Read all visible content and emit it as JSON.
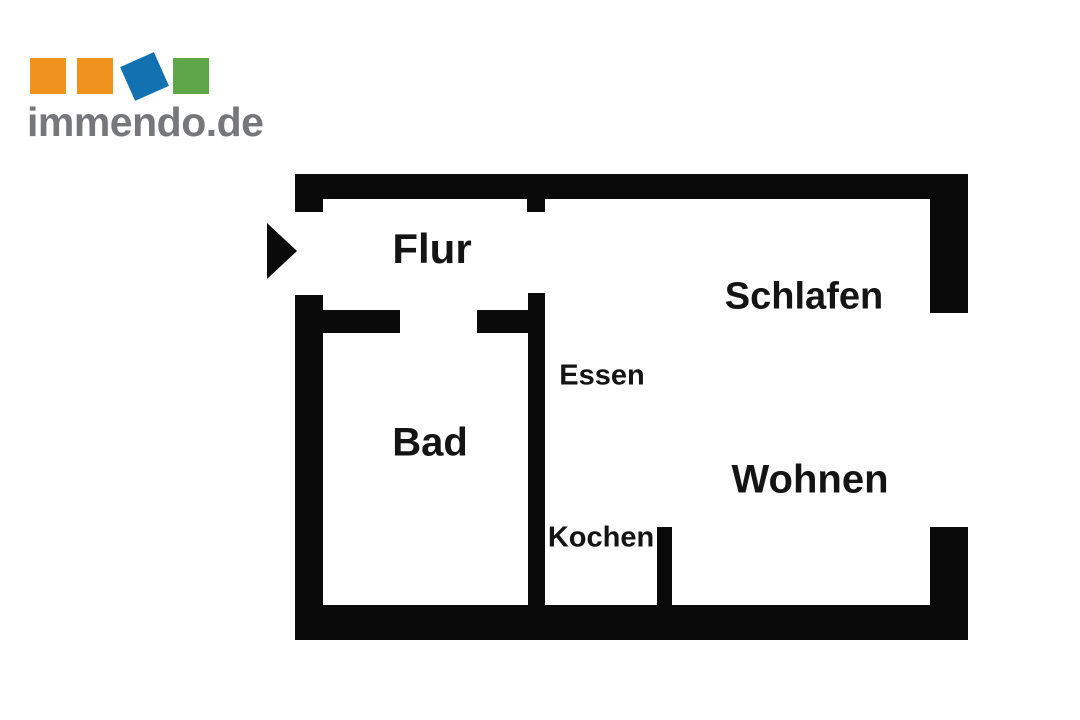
{
  "logo": {
    "text": "immendo.de",
    "text_color": "#76777B",
    "squares": [
      {
        "name": "orange-square-1",
        "color": "#F0921E"
      },
      {
        "name": "orange-square-2",
        "color": "#F0921E"
      },
      {
        "name": "blue-square-rotated",
        "color": "#1272B1"
      },
      {
        "name": "green-square",
        "color": "#5EA649"
      }
    ]
  },
  "floorplan": {
    "wall_color": "#0A0A0A",
    "label_color": "#141414",
    "entrance_marker": "right-pointing-triangle",
    "rooms": [
      {
        "label": "Flur"
      },
      {
        "label": "Schlafen"
      },
      {
        "label": "Essen"
      },
      {
        "label": "Bad"
      },
      {
        "label": "Kochen"
      },
      {
        "label": "Wohnen"
      }
    ]
  }
}
